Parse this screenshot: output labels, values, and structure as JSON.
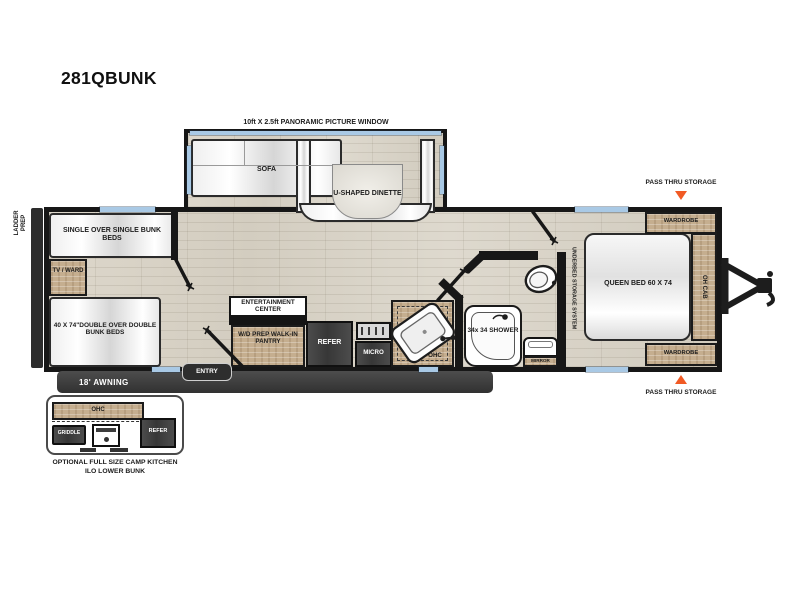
{
  "title": "281QBUNK",
  "colors": {
    "accent_triangle": "#f15a24",
    "wall": "#171717",
    "window_glass": "#a9c9e5",
    "cabinet_wood": "#c5ae8f",
    "floor": "#d8d2c6",
    "appliance_dark": "#444444",
    "awning_bar": "#3a3a3a"
  },
  "plan": {
    "window_label": "10ft X 2.5ft PANORAMIC PICTURE WINDOW",
    "ladder_prep": "LADDER PREP",
    "awning": "18' AWNING",
    "entry": "ENTRY",
    "pass_thru": "PASS THRU STORAGE",
    "living": {
      "sofa": "SOFA",
      "dinette": "U-SHAPED DINETTE"
    },
    "bunk_room": {
      "single_bunks": "SINGLE OVER SINGLE BUNK BEDS",
      "tv_ward": "TV / WARD",
      "double_bunks": "40 X 74\"DOUBLE OVER DOUBLE BUNK BEDS"
    },
    "kitchen": {
      "entertainment_center": "ENTERTAINMENT CENTER",
      "pantry": "W/D PREP WALK-IN PANTRY",
      "refer": "REFER",
      "micro": "MICRO",
      "ohc": "OHC"
    },
    "bath": {
      "shower": "34x 34 SHOWER",
      "mirror": "MIRROR"
    },
    "bedroom": {
      "underbed": "UNDERBED STORAGE SYSTEM",
      "queen_bed": "QUEEN BED 60 X 74",
      "oh_cab": "OH CAB",
      "wardrobe": "WARDROBE"
    },
    "camp_kitchen": {
      "ohc": "OHC",
      "griddle": "GRIDDLE",
      "refer": "REFER",
      "caption_line1": "OPTIONAL FULL SIZE CAMP KITCHEN",
      "caption_line2": "ILO LOWER BUNK"
    }
  }
}
